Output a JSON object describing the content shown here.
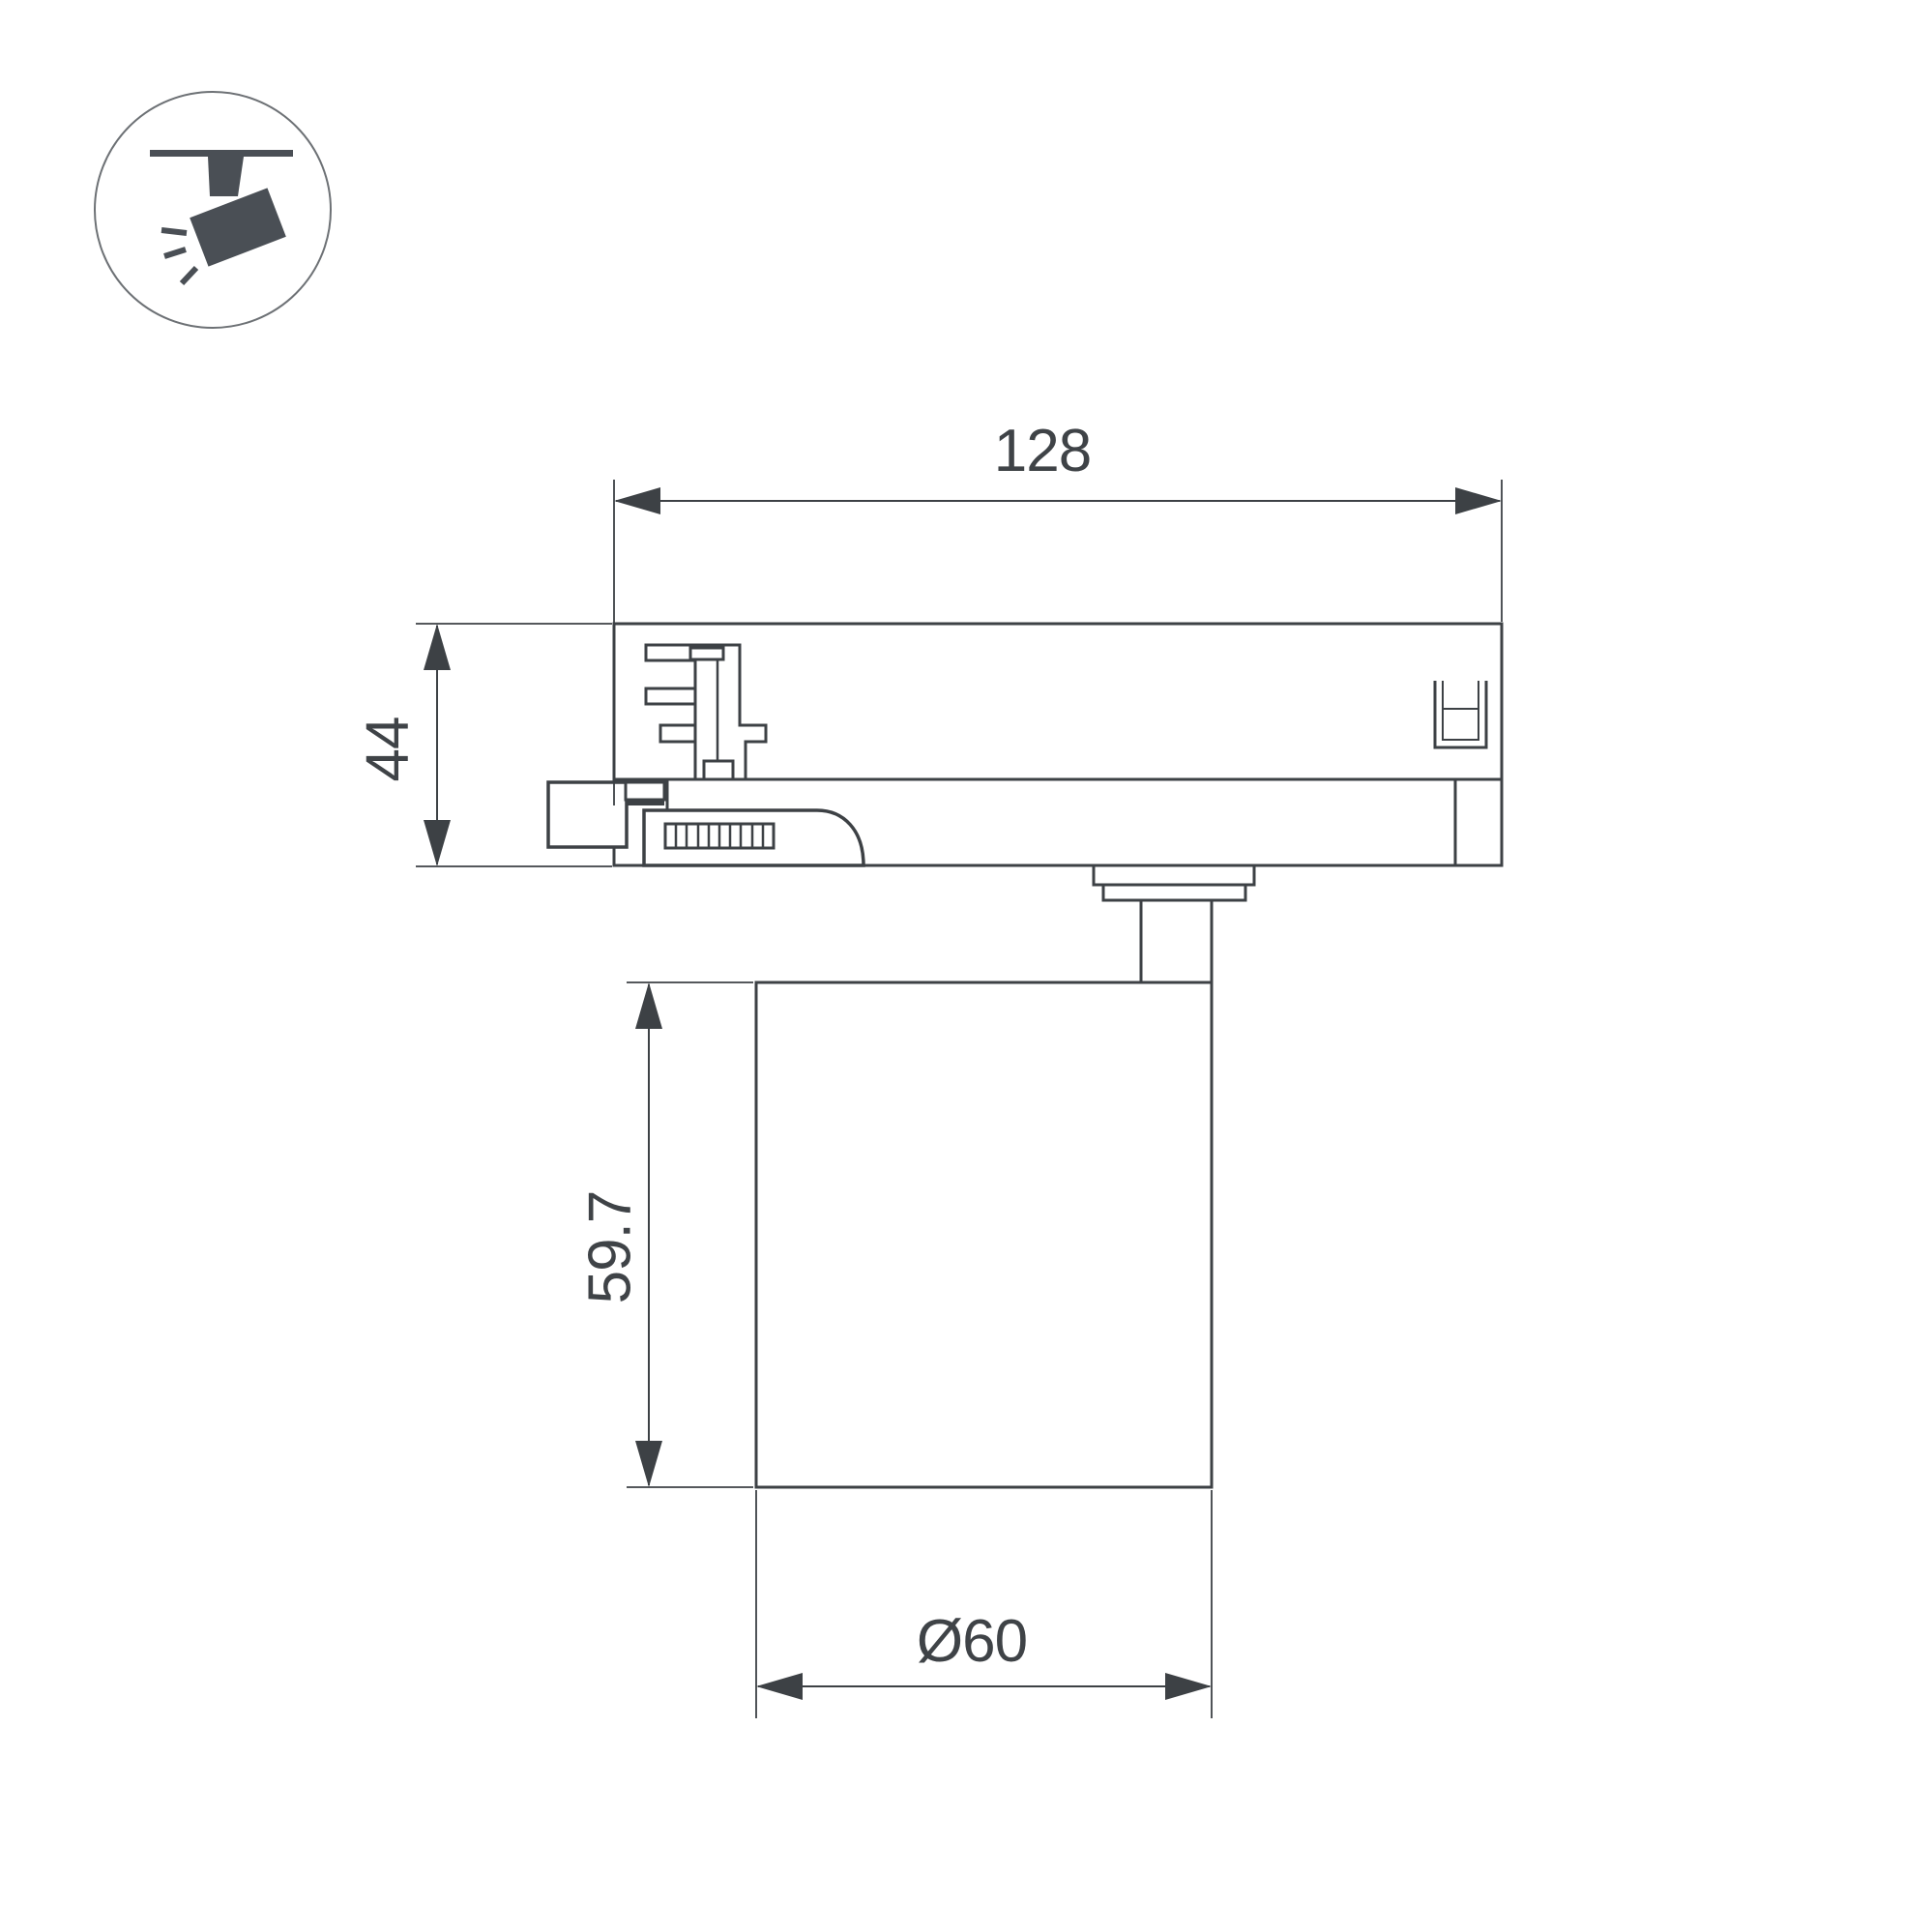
{
  "drawing": {
    "type": "technical-dimension-drawing",
    "subject": "track-mounted spotlight, side view",
    "dimensions": {
      "adapter_width": "128",
      "adapter_height": "44",
      "lamp_height": "59.7",
      "lamp_diameter": "Ø60"
    },
    "colors": {
      "line": "#3d4145",
      "text": "#3f4347",
      "icon": "#4a4f55",
      "background": "#ffffff"
    }
  }
}
